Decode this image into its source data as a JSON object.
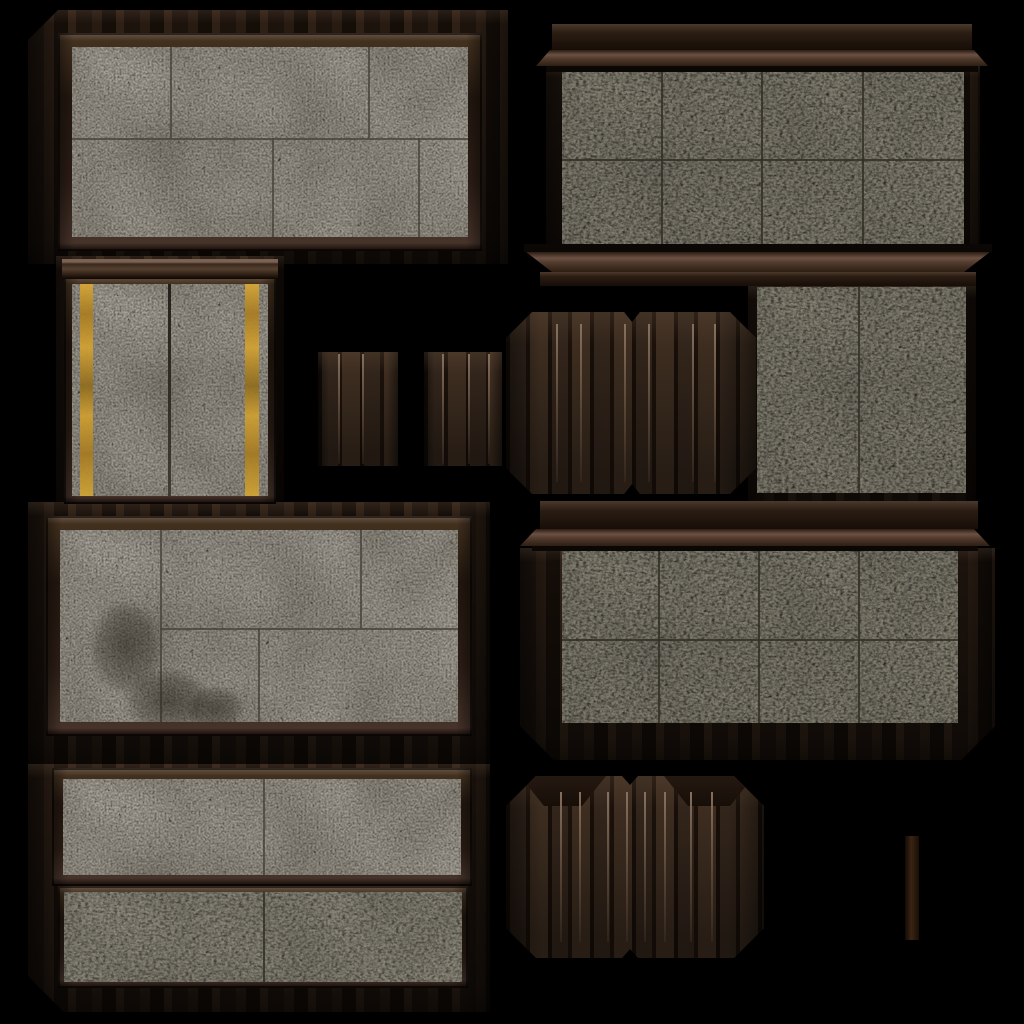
{
  "meta": {
    "title": "dungeon-wall-texture-atlas",
    "canvas_w": 1024,
    "canvas_h": 1024,
    "background": "#000000"
  },
  "palette": {
    "concrete_light": "#a7a297",
    "concrete_olive": "#8b8777",
    "concrete_olive_light": "#938f80",
    "grout_light": "rgba(72,68,56,0.8)",
    "grout_olive": "rgba(50,48,38,0.85)",
    "wood_frame": "#3d2c20",
    "wood_dark": "#1f150e",
    "hazard_yellow": "#cfa031",
    "plank_highlight": "#8a7361"
  },
  "atlas": {
    "tiles": [
      {
        "name": "wood-backdrop-top-left",
        "kind": "wood",
        "x": 28,
        "y": 10,
        "w": 480,
        "h": 254,
        "chamfer": [
          30,
          0,
          0,
          0
        ]
      },
      {
        "name": "wood-backdrop-top-right",
        "kind": "wood",
        "x": 546,
        "y": 64,
        "w": 434,
        "h": 190
      },
      {
        "name": "wood-backdrop-yellow-panel",
        "kind": "wood",
        "x": 56,
        "y": 256,
        "w": 228,
        "h": 264
      },
      {
        "name": "wood-backdrop-mid-right",
        "kind": "wood",
        "x": 748,
        "y": 285,
        "w": 228,
        "h": 228
      },
      {
        "name": "wood-backdrop-center-left",
        "kind": "wood",
        "x": 28,
        "y": 502,
        "w": 462,
        "h": 262
      },
      {
        "name": "wood-body-center-right",
        "kind": "wood",
        "x": 520,
        "y": 548,
        "w": 475,
        "h": 212,
        "chamfer": [
          0,
          0,
          34,
          34
        ]
      },
      {
        "name": "wood-backdrop-bottom-left",
        "kind": "wood",
        "x": 28,
        "y": 764,
        "w": 462,
        "h": 248,
        "chamfer": [
          0,
          0,
          0,
          36
        ]
      },
      {
        "name": "concrete-blocks-top-left",
        "kind": "concrete",
        "x": 58,
        "y": 33,
        "w": 424,
        "h": 218,
        "frame": 14,
        "pal": "light",
        "hline": {
          "y": 91
        },
        "vtop": [
          98,
          296
        ],
        "vbot": [
          200,
          346
        ]
      },
      {
        "name": "concrete-tiles-top-right",
        "kind": "concrete",
        "x": 562,
        "y": 70,
        "w": 402,
        "h": 178,
        "pal": "olive",
        "hline": {
          "y": 89
        },
        "vfull": [
          99,
          199,
          300
        ]
      },
      {
        "name": "concrete-yellow-stripes",
        "kind": "concrete",
        "x": 64,
        "y": 276,
        "w": 212,
        "h": 228,
        "frame": 8,
        "pal": "light",
        "crack": {
          "x": 96,
          "w": 3
        },
        "stripes": [
          {
            "x": 8,
            "w": 13
          },
          {
            "x": 173,
            "w": 14
          }
        ]
      },
      {
        "name": "concrete-mid-right",
        "kind": "concrete",
        "x": 757,
        "y": 287,
        "w": 209,
        "h": 206,
        "pal": "olive",
        "vfull": [
          101
        ]
      },
      {
        "name": "concrete-blocks-center-left",
        "kind": "concrete",
        "x": 46,
        "y": 516,
        "w": 426,
        "h": 220,
        "frame": 14,
        "pal": "light",
        "hline": {
          "y": 98,
          "x0": 100
        },
        "vfull": [
          100
        ],
        "vtop": [
          300
        ],
        "vbot": [
          198
        ],
        "stains": [
          {
            "x": 18,
            "y": 55,
            "w": 95,
            "h": 125
          },
          {
            "x": 50,
            "y": 128,
            "w": 115,
            "h": 85
          },
          {
            "x": 118,
            "y": 148,
            "w": 75,
            "h": 62
          }
        ]
      },
      {
        "name": "concrete-tiles-center-right",
        "kind": "concrete",
        "x": 562,
        "y": 551,
        "w": 396,
        "h": 172,
        "pal": "olive",
        "hline": {
          "y": 88
        },
        "vfull": [
          96,
          196,
          296
        ]
      },
      {
        "name": "concrete-strip-bottom-1",
        "kind": "concrete",
        "x": 52,
        "y": 768,
        "w": 420,
        "h": 118,
        "frame": 11,
        "pal": "light",
        "vfull": [
          200
        ]
      },
      {
        "name": "concrete-strip-bottom-2",
        "kind": "concrete",
        "x": 58,
        "y": 886,
        "w": 410,
        "h": 102,
        "frame": 6,
        "pal": "olive2",
        "vfull": [
          199
        ]
      },
      {
        "name": "cornice-top-right",
        "kind": "bars",
        "x": 536,
        "y": 24,
        "w": 452,
        "h": 48,
        "bars": [
          {
            "dx": 16,
            "dy": 0,
            "w": 420,
            "h": 26,
            "cls": "barDark"
          },
          {
            "dx": 0,
            "dy": 26,
            "w": 452,
            "h": 16,
            "cls": "barMid",
            "clip": "flare",
            "inset": 14
          },
          {
            "dx": 10,
            "dy": 42,
            "w": 432,
            "h": 6,
            "cls": "shadowbar"
          }
        ]
      },
      {
        "name": "sill-top-right",
        "kind": "bars",
        "x": 524,
        "y": 244,
        "w": 468,
        "h": 42,
        "bars": [
          {
            "dx": 0,
            "dy": 0,
            "w": 468,
            "h": 8,
            "cls": "shadowbar"
          },
          {
            "dx": 2,
            "dy": 8,
            "w": 464,
            "h": 20,
            "cls": "barMid",
            "clip": "narrow",
            "inset": 26
          },
          {
            "dx": 16,
            "dy": 28,
            "w": 436,
            "h": 14,
            "cls": "barDark"
          }
        ]
      },
      {
        "name": "rail-yellow-panel",
        "kind": "bars",
        "x": 62,
        "y": 259,
        "w": 216,
        "h": 20,
        "bars": [
          {
            "dx": 0,
            "dy": 0,
            "w": 216,
            "h": 20,
            "cls": "rail"
          }
        ]
      },
      {
        "name": "cornice-center-right",
        "kind": "bars",
        "x": 520,
        "y": 501,
        "w": 470,
        "h": 50,
        "bars": [
          {
            "dx": 20,
            "dy": 0,
            "w": 438,
            "h": 28,
            "cls": "barDark"
          },
          {
            "dx": 0,
            "dy": 28,
            "w": 470,
            "h": 17,
            "cls": "barMid",
            "clip": "flare",
            "inset": 16
          },
          {
            "dx": 12,
            "dy": 45,
            "w": 446,
            "h": 5,
            "cls": "shadowbar"
          }
        ]
      },
      {
        "name": "plank-strip-left",
        "kind": "planks",
        "x": 318,
        "y": 352,
        "w": 80,
        "h": 114,
        "highlights": [
          20,
          44
        ]
      },
      {
        "name": "plank-strip-right",
        "kind": "planks",
        "x": 424,
        "y": 352,
        "w": 78,
        "h": 114,
        "highlights": [
          18,
          44,
          64
        ]
      },
      {
        "name": "plank-panel-middle",
        "kind": "planks",
        "x": 506,
        "y": 312,
        "w": 250,
        "h": 182,
        "chamfer": 26,
        "notch_top": {
          "x": 118,
          "w": 16,
          "d": 10
        },
        "notch_bottom": {
          "x": 118,
          "w": 16,
          "d": 10
        },
        "highlights": [
          50,
          74,
          118,
          142,
          186,
          208
        ]
      },
      {
        "name": "plank-panel-bottom",
        "kind": "planks",
        "x": 506,
        "y": 776,
        "w": 258,
        "h": 182,
        "chamfer": 30,
        "notch_top": {
          "x": 116,
          "w": 16,
          "d": 9
        },
        "notch_bottom": {
          "x": 116,
          "w": 16,
          "d": 9
        },
        "merlons": [
          {
            "x": 14,
            "w": 86,
            "h": 30
          },
          {
            "x": 158,
            "w": 90,
            "h": 30
          }
        ],
        "highlights": [
          54,
          73,
          101,
          120,
          138,
          158,
          184,
          205
        ]
      },
      {
        "name": "wood-bar-small",
        "kind": "bar",
        "x": 905,
        "y": 836,
        "w": 14,
        "h": 104
      }
    ]
  }
}
